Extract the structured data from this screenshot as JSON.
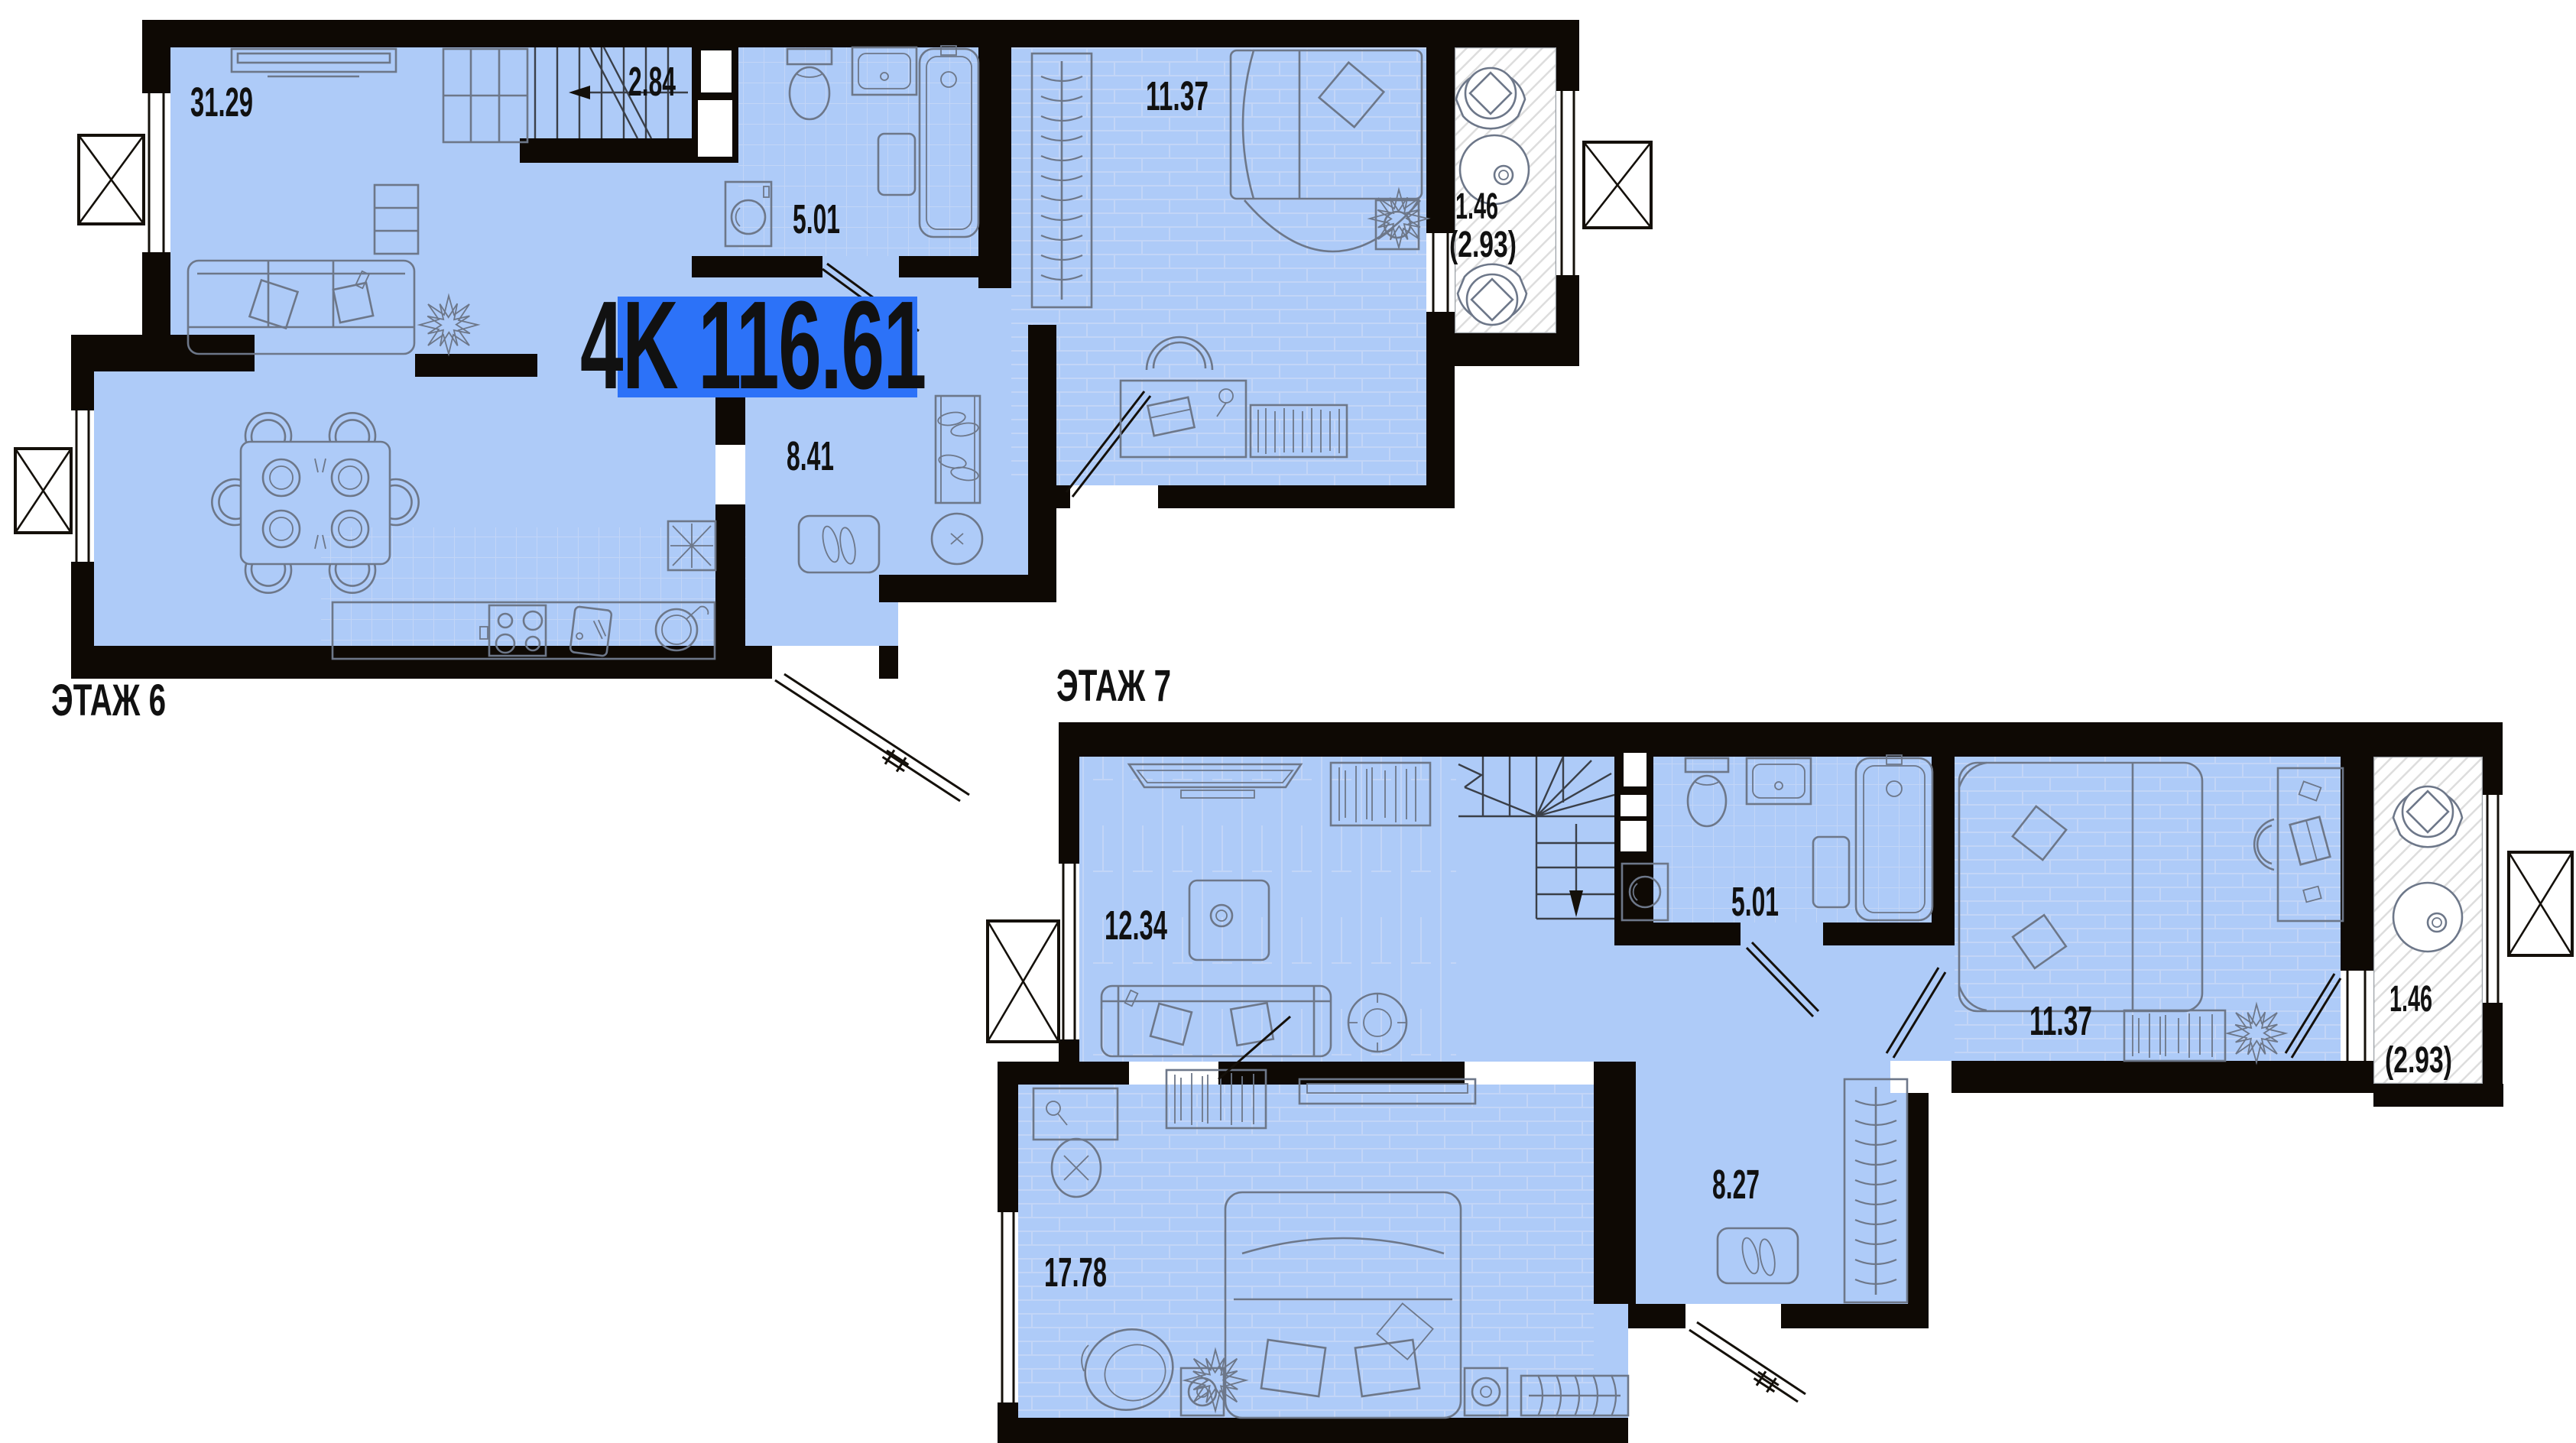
{
  "apartment_badge": {
    "type_label": "4K",
    "area_value": "116.61",
    "full_text": "4K 116.61"
  },
  "colors": {
    "room_fill": "#aecbf8",
    "badge_blue": "#2c72f8",
    "wall_black": "#0e0904",
    "floor_label_gray": "#9a9a9a",
    "furniture_line": "#6d7789"
  },
  "floor6": {
    "label": "ЭТАЖ 6",
    "rooms": {
      "living": {
        "name": "living-dining-room",
        "area": "31.29"
      },
      "stairs": {
        "name": "stair-hall",
        "area": "2.84"
      },
      "bathroom": {
        "name": "bathroom",
        "area": "5.01"
      },
      "bedroom": {
        "name": "bedroom",
        "area": "11.37"
      },
      "balcony": {
        "name": "balcony",
        "area": "1.46",
        "area_total": "(2.93)"
      },
      "hallway": {
        "name": "entrance-hall",
        "area": "8.41"
      }
    }
  },
  "floor7": {
    "label": "ЭТАЖ 7",
    "rooms": {
      "living": {
        "name": "living-room",
        "area": "12.34"
      },
      "bathroom": {
        "name": "bathroom",
        "area": "5.01"
      },
      "bedroom": {
        "name": "bedroom",
        "area": "11.37"
      },
      "balcony": {
        "name": "balcony",
        "area": "1.46",
        "area_total": "(2.93)"
      },
      "master": {
        "name": "master-bedroom",
        "area": "17.78"
      },
      "hallway": {
        "name": "entrance-hall",
        "area": "8.27"
      }
    }
  }
}
